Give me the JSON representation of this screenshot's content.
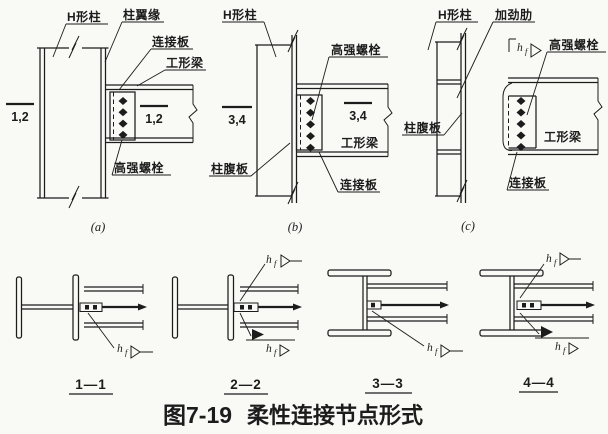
{
  "colors": {
    "ink": "#1c1c1c",
    "paper": "#f9f9f6"
  },
  "figure": {
    "caption_prefix": "图7-19",
    "caption_title": "柔性连接节点形式",
    "weld": {
      "main": "h",
      "sub": "f"
    }
  },
  "panels": {
    "a": {
      "tag": "(a)",
      "bolt_count": 4,
      "labels": {
        "column": "H形柱",
        "column_flange": "柱翼缘",
        "connection_plate": "连接板",
        "beam": "工形梁",
        "bolts": "高强螺栓",
        "section_left": "1,2",
        "section_right": "1,2"
      }
    },
    "b": {
      "tag": "(b)",
      "bolt_count": 5,
      "labels": {
        "column": "H形柱",
        "bolts": "高强螺栓",
        "column_web": "柱腹板",
        "beam": "工形梁",
        "connection_plate": "连接板",
        "section_left": "3,4",
        "section_right": "3,4"
      }
    },
    "c": {
      "tag": "(c)",
      "bolt_count": 5,
      "labels": {
        "column": "H形柱",
        "stiffener": "加劲肋",
        "bolts": "高强螺栓",
        "column_web": "柱腹板",
        "beam": "工形梁",
        "connection_plate": "连接板"
      }
    }
  },
  "sections": {
    "s1": {
      "tag": "1—1"
    },
    "s2": {
      "tag": "2—2"
    },
    "s3": {
      "tag": "3—3"
    },
    "s4": {
      "tag": "4—4"
    }
  }
}
